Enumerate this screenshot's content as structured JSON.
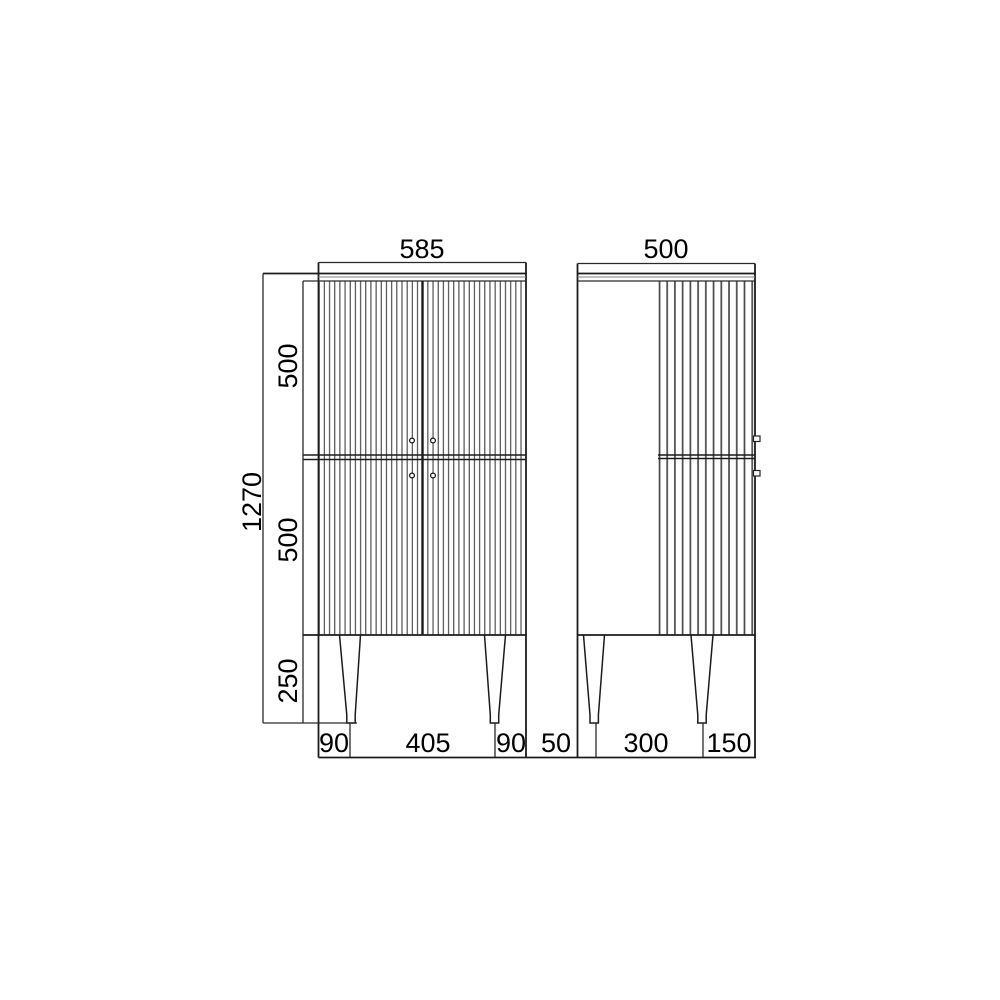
{
  "drawing": {
    "type": "furniture-dimension-drawing",
    "units_implied": "mm",
    "front_view": {
      "width_label": "585",
      "total_height_label": "1270",
      "upper_door_height_label": "500",
      "lower_door_height_label": "500",
      "leg_height_label": "250",
      "bottom_left_offset_label": "90",
      "bottom_leg_span_label": "405",
      "bottom_right_offset_label": "90"
    },
    "side_view": {
      "depth_label": "500",
      "bottom_back_offset_label": "50",
      "bottom_leg_span_label": "300",
      "bottom_front_offset_label": "150"
    },
    "line_color": "#1c1c1c",
    "flute_color": "#454545",
    "background_color": "#ffffff"
  }
}
